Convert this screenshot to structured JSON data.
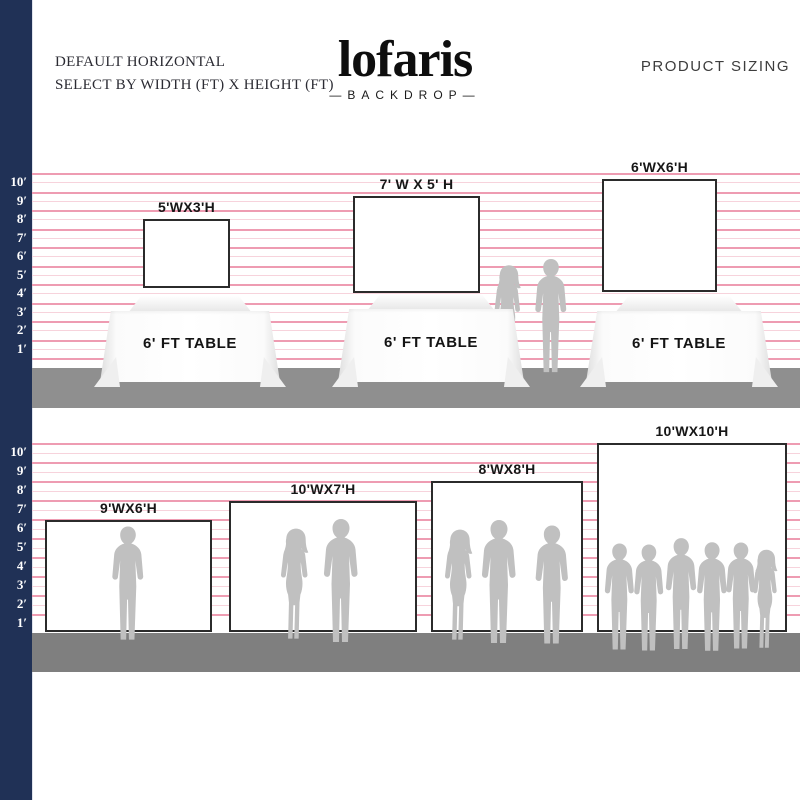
{
  "header": {
    "left_line1": "DEFAULT HORIZONTAL",
    "left_line2": "SELECT BY WIDTH (FT) X HEIGHT (FT)",
    "logo": "lofaris",
    "logo_sub": "—BACKDROP—",
    "right": "PRODUCT SIZING"
  },
  "scale_labels": [
    "10′",
    "9′",
    "8′",
    "7′",
    "6′",
    "5′",
    "4′",
    "3′",
    "2′",
    "1′"
  ],
  "sections": [
    {
      "name": "backdrops-on-tables",
      "table_label": "6' FT TABLE",
      "backdrops": [
        {
          "label": "5'WX3'H"
        },
        {
          "label": "7' W X 5' H"
        },
        {
          "label": "6'WX6'H"
        }
      ]
    },
    {
      "name": "backdrops-with-people",
      "backdrops": [
        {
          "label": "9'WX6'H"
        },
        {
          "label": "10'WX7'H"
        },
        {
          "label": "8'WX8'H"
        },
        {
          "label": "10'WX10'H"
        }
      ]
    }
  ],
  "colors": {
    "navy_bar": "#203156",
    "grid_line": "#ee9cb2",
    "grid_line_light": "#f7d3dc",
    "ground_top": "#8f8f8f",
    "ground_bottom": "#7f7f7f",
    "silhouette": "#c0c0c0",
    "backdrop_border": "#2b2b2b"
  }
}
